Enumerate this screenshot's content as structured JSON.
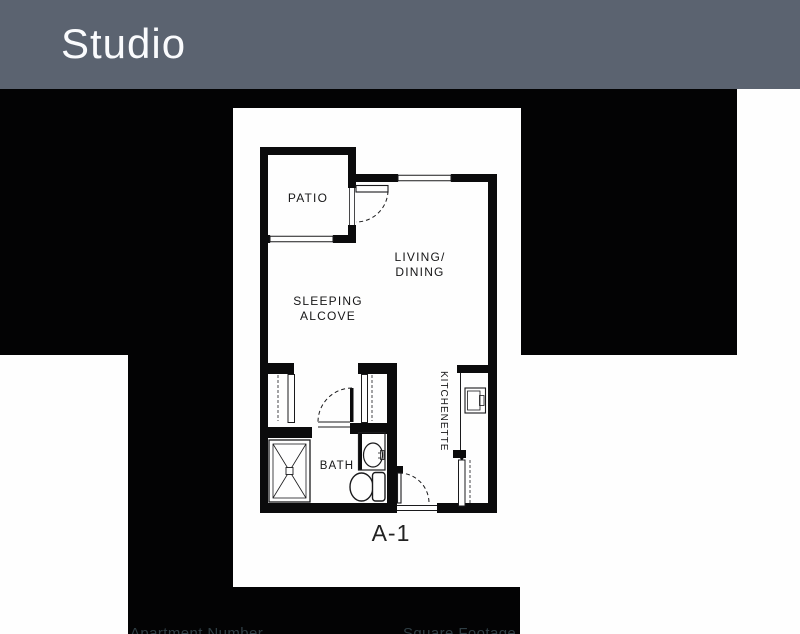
{
  "header": {
    "title": "Studio"
  },
  "floor_plan": {
    "patio": "PATIO",
    "living_line1": "LIVING/",
    "living_line2": "DINING",
    "sleeping_line1": "SLEEPING",
    "sleeping_line2": "ALCOVE",
    "kitchenette": "KITCHENETTE",
    "bath": "BATH",
    "unit": "A-1"
  },
  "footer": {
    "apartment_number": "Apartment Number",
    "square_footage": "Square Footage"
  },
  "colors": {
    "header_bg": "#5b6370",
    "header_text": "#fafbfd",
    "background_black": "#030304",
    "panel_white": "#fefefe",
    "plan_ink": "#0b0b0c",
    "footer_text": "#2f3e44"
  }
}
